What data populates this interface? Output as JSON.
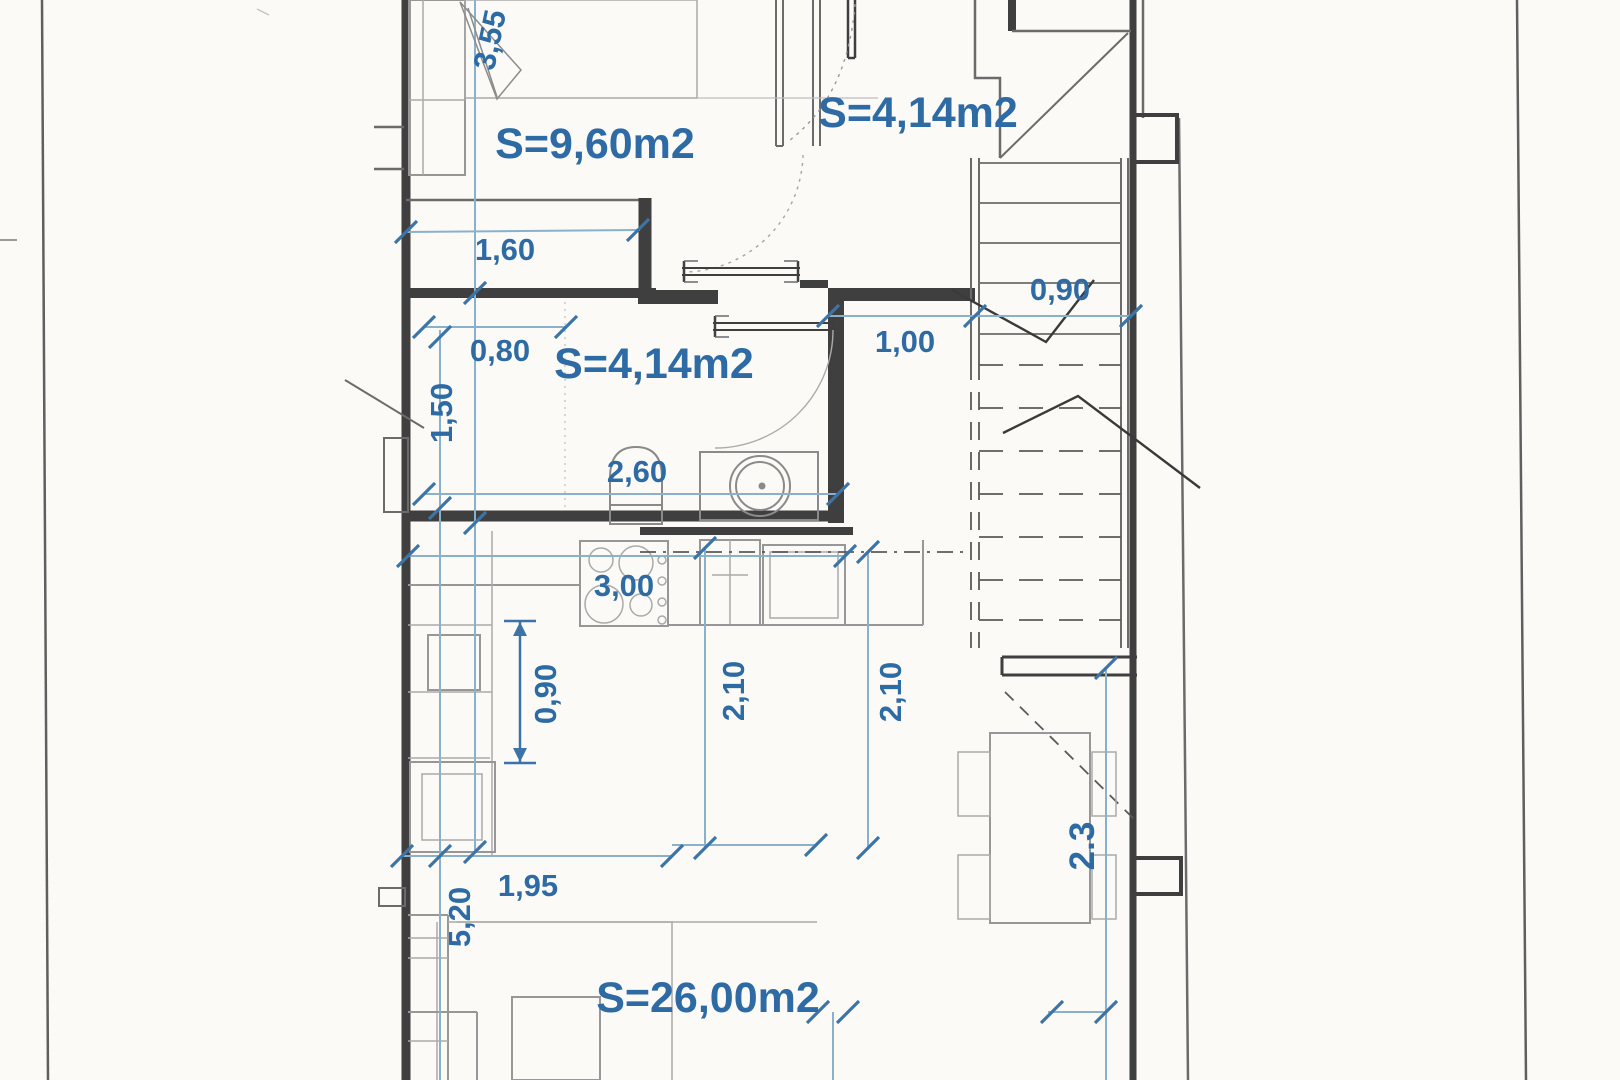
{
  "plan": {
    "room_labels": {
      "bedroom": "S=9,60m2",
      "entry": "S=4,14m2",
      "bathroom": "S=4,14m2",
      "living": "S=26,00m2"
    },
    "dimensions": {
      "bedroom_height": "3,55",
      "bedroom_niche": "1,60",
      "bath_top": "0,80",
      "bath_left": "1,50",
      "bath_width": "2,60",
      "hall_width": "1,00",
      "stair_width": "0,90",
      "kitchen_width": "3,00",
      "kitchen_depth": "0,90",
      "living_col_left": "2,10",
      "living_col_right": "2,10",
      "living_bottom": "1,95",
      "living_height": "5,20",
      "dining_height": "2.3"
    },
    "colors": {
      "label_blue": "#2e6ba4",
      "dim_line_blue": "#8ab1cc",
      "wall_ink": "#3f3f3f"
    }
  }
}
